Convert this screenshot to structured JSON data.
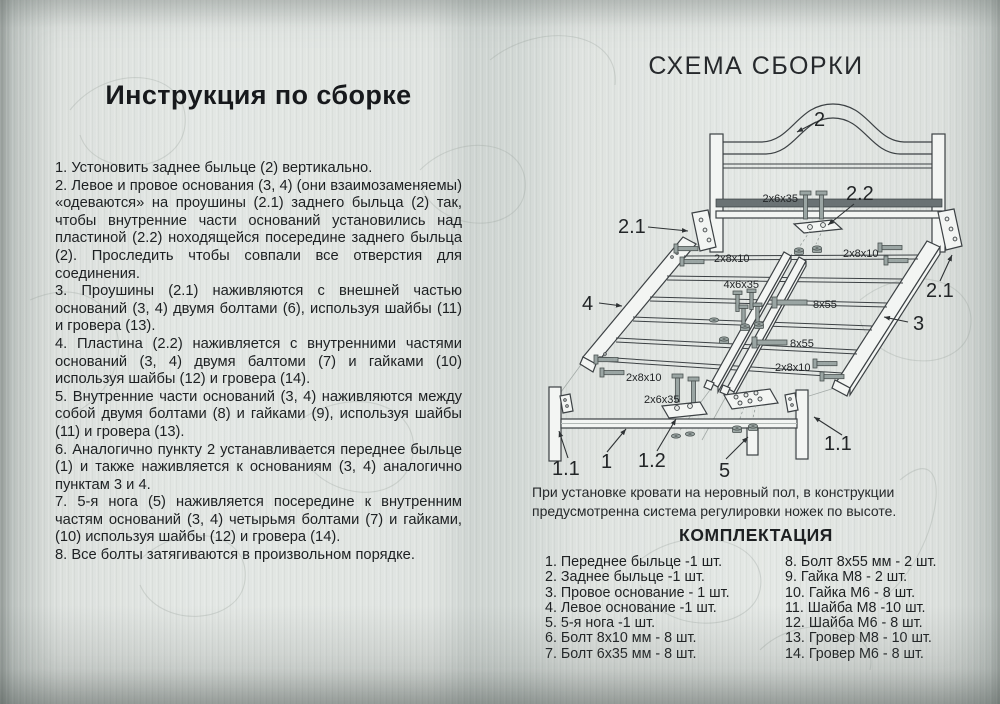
{
  "left": {
    "title": "Инструкция по сборке",
    "steps": [
      "1.  Устоновить заднее быльце (2) вертикально.",
      "2.  Левое и провое основания (3, 4) (они взаимозаменяемы) «одеваются» на проушины (2.1) заднего быльца (2) так, чтобы внутренние части оснований установились над пластиной (2.2) ноходящейся посередине заднего быльца (2). Проследить чтобы совпали все отверстия для соединения.",
      "3.  Проушины (2.1) наживляются с внешней частью оснований (3, 4) двумя болтами (6), используя шайбы (11) и гровера (13).",
      "4.  Пластина (2.2) наживляется с внутренними частями оснований (3, 4) двумя балтоми (7) и гайками (10) используя шайбы (12) и гровера (14).",
      "5.  Внутренние части оснований (3, 4) наживляются между собой двумя болтами (8) и гайками (9), используя шайбы (11) и гровера (13).",
      "6.  Аналогично пункту 2 устанавливается переднее быльце (1) и также наживляется к основаниям (3, 4) аналогично пунктам 3 и 4.",
      "7.  5-я нога (5) наживляется посередине к внутренним частям оснований (3, 4) четырьмя болтами (7) и гайками, (10) используя шайбы (12) и гровера (14).",
      "8.  Все болты затягиваются в произвольном порядке."
    ]
  },
  "right": {
    "title": "СХЕМА СБОРКИ",
    "note": "При установке кровати на неровный пол, в конструкции предусмотренна система регулировки ножек по высоте.",
    "parts_title": "КОМПЛЕКТАЦИЯ",
    "parts_left": [
      "1. Переднее быльце -1 шт.",
      "2. Заднее быльце -1 шт.",
      "3. Провое основание - 1 шт.",
      "4. Левое основание -1 шт.",
      "5. 5-я нога -1 шт.",
      "6. Болт 8х10 мм - 8 шт.",
      "7. Болт 6х35 мм - 8 шт."
    ],
    "parts_right": [
      "8. Болт 8х55 мм - 2 шт.",
      "9. Гайка М8 - 2 шт.",
      "10. Гайка М6 - 8 шт.",
      "11. Шайба М8 -10 шт.",
      "12. Шайба М6 - 8 шт.",
      "13. Гровер М8 - 10 шт.",
      "14. Гровер М6 - 8 шт."
    ]
  },
  "diagram": {
    "labels": {
      "headboard": "2",
      "bracket": "2.1",
      "plate": "2.2",
      "right_base": "3",
      "left_base": "4",
      "front_rail": "1",
      "front_leg": "1.1",
      "front_plate": "1.2",
      "fifth_leg": "5"
    },
    "bolt_labels": {
      "b2x6x35": "2x6x35",
      "b2x8x10": "2x8x10",
      "b4x6x35": "4x6x35",
      "b8x55": "8x55"
    },
    "colors": {
      "line": "#3c4144",
      "metal": "#9aa5a3",
      "dark_bar": "#687072"
    }
  }
}
